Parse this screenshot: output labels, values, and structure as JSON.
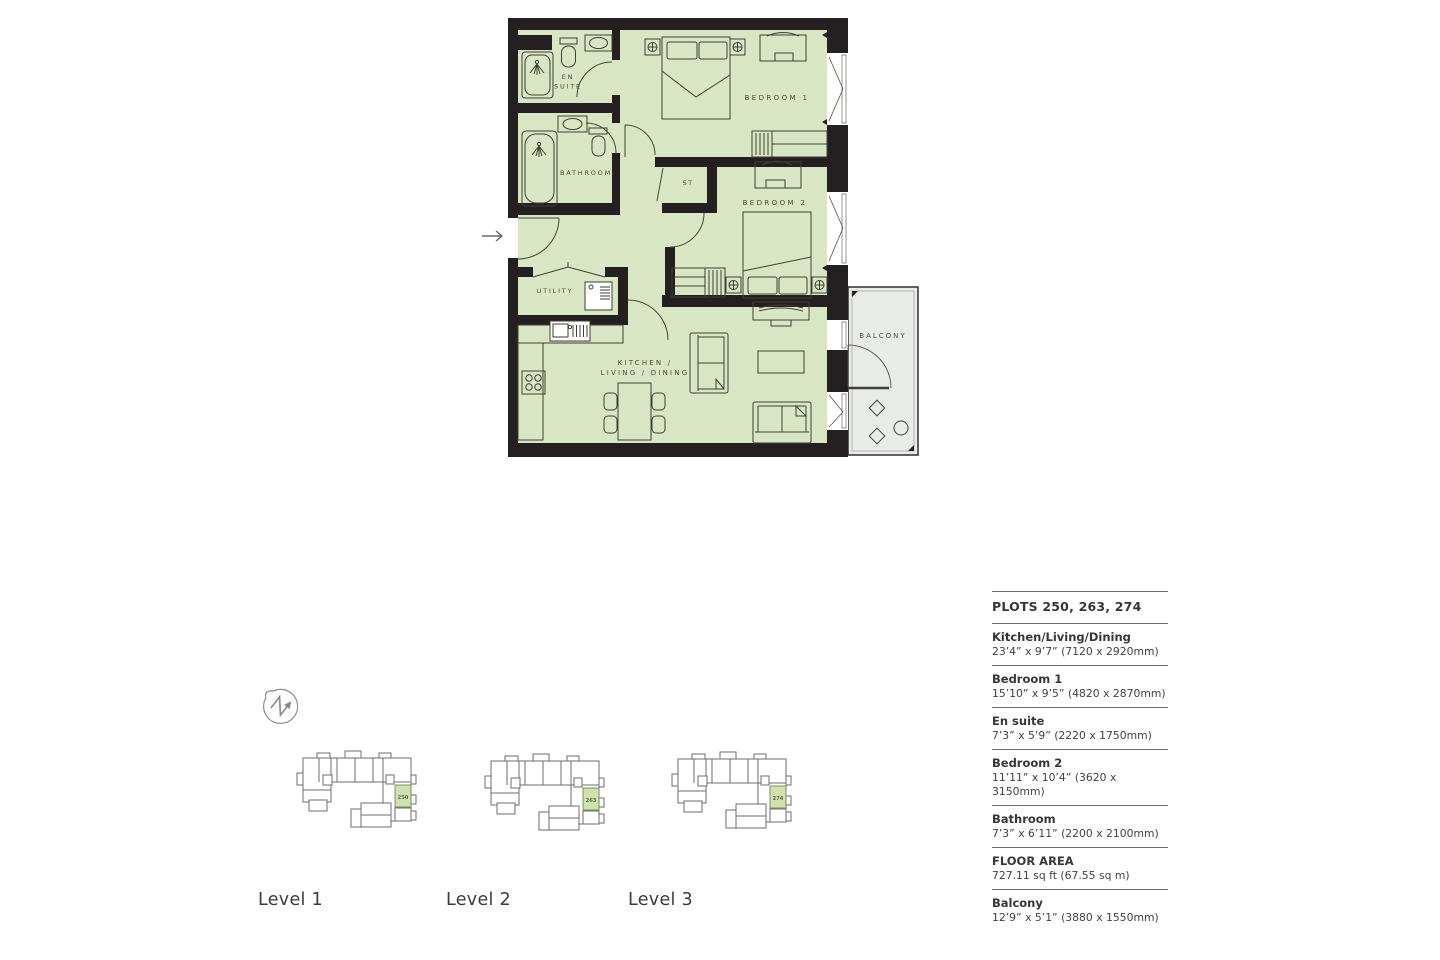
{
  "plan": {
    "rooms": {
      "en_suite_line1": "EN",
      "en_suite_line2": "SUITE",
      "bathroom": "BATHROOM",
      "utility": "UTILITY",
      "storage": "ST",
      "bedroom1": "BEDROOM 1",
      "bedroom2": "BEDROOM 2",
      "kitchen_line1": "KITCHEN /",
      "kitchen_line2": "LIVING / DINING",
      "balcony": "BALCONY"
    }
  },
  "levels": {
    "items": [
      {
        "label": "Level 1",
        "plot": "250"
      },
      {
        "label": "Level 2",
        "plot": "263"
      },
      {
        "label": "Level 3",
        "plot": "274"
      }
    ]
  },
  "panel": {
    "title": "PLOTS 250, 263, 274",
    "entries": [
      {
        "name": "Kitchen/Living/Dining",
        "dims": "23’4” x 9’7” (7120 x 2920mm)"
      },
      {
        "name": "Bedroom 1",
        "dims": "15’10” x 9’5” (4820 x 2870mm)"
      },
      {
        "name": "En suite",
        "dims": "7’3” x 5’9” (2220 x 1750mm)"
      },
      {
        "name": "Bedroom 2",
        "dims": "11’11” x 10’4” (3620 x 3150mm)"
      },
      {
        "name": "Bathroom",
        "dims": "7’3” x 6’11” (2200 x 2100mm)"
      },
      {
        "name": "FLOOR AREA",
        "dims": "727.11 sq ft (67.55 sq m)"
      },
      {
        "name": "Balcony",
        "dims": "12’9” x 5’1” (3880 x 1550mm)"
      }
    ]
  },
  "colors": {
    "plan_fill": "#d8e6c4",
    "wall": "#242021",
    "balcony_fill": "#e9ebe8",
    "furniture_line": "#3f3f35",
    "unit_highlight": "#cfe1ad",
    "rule": "#6b6b6b",
    "text": "#393734"
  }
}
